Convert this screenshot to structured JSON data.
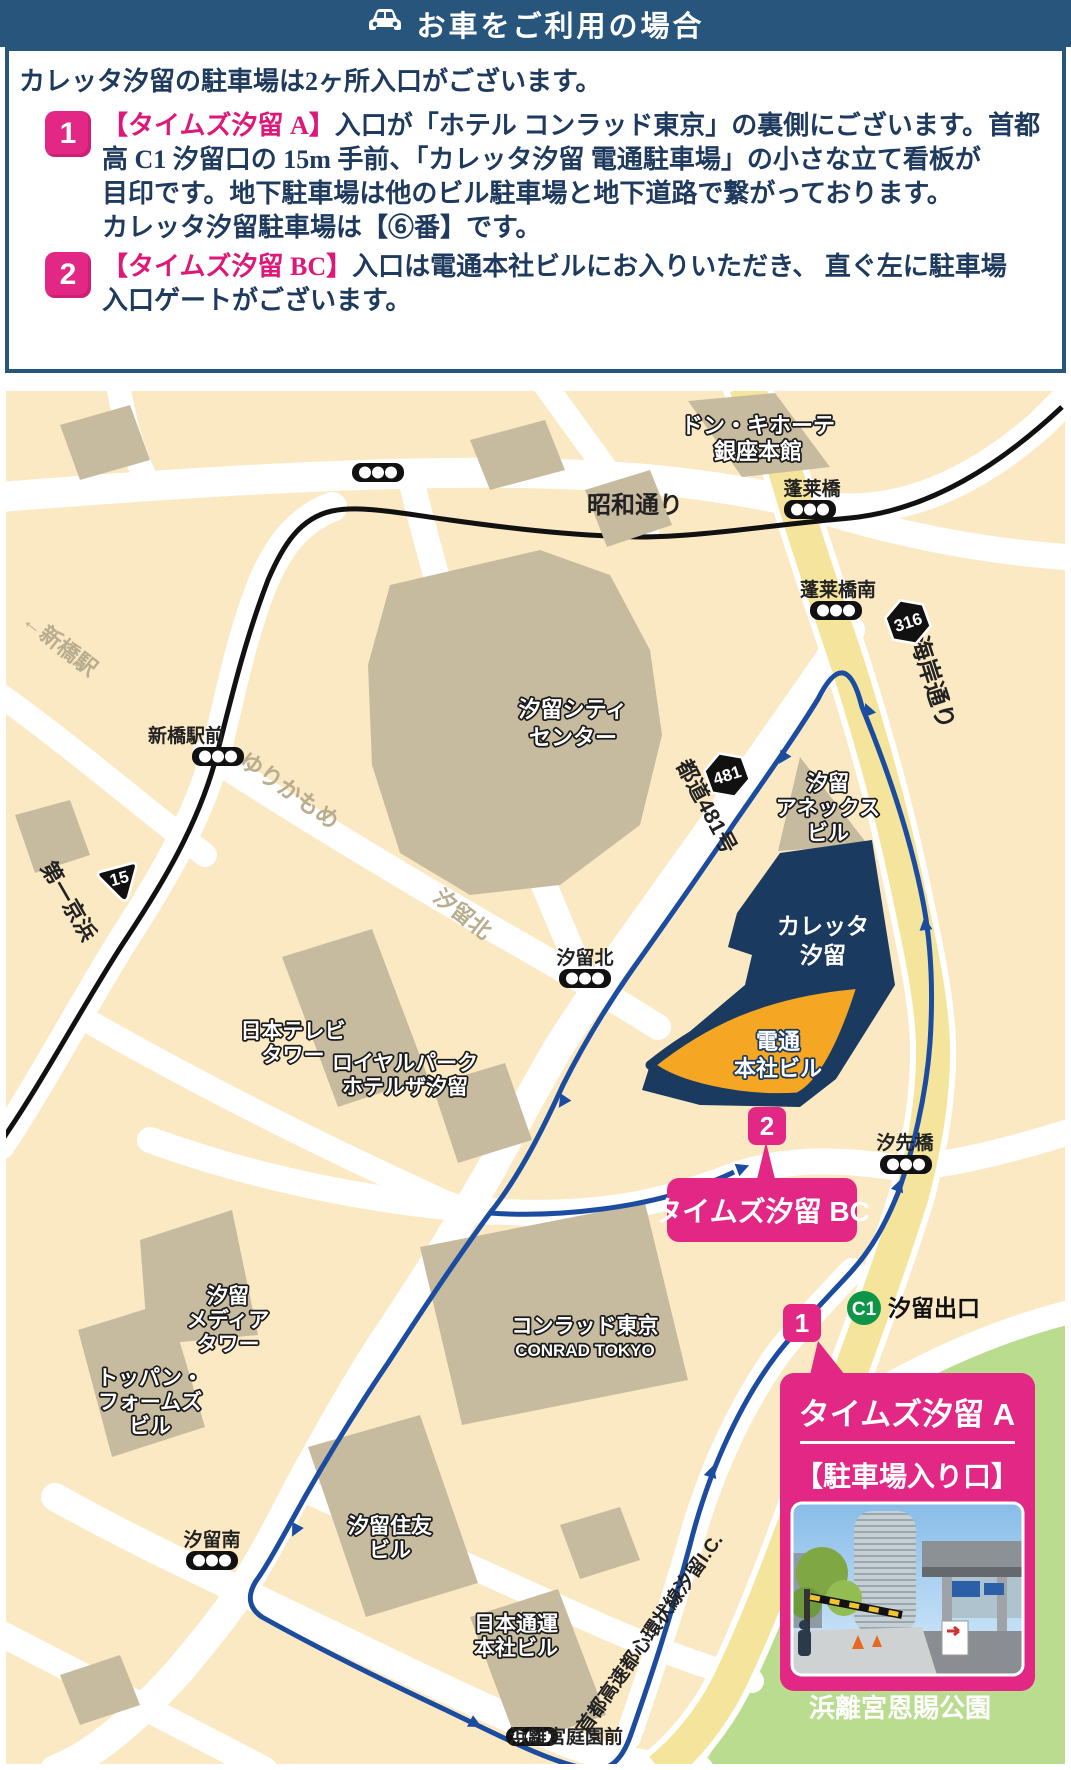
{
  "title_bar": {
    "title": "お車をご利用の場合"
  },
  "intro": "カレッタ汐留の駐車場は2ヶ所入口がございます。",
  "items": [
    {
      "num": "1",
      "head": "【タイムズ汐留 A】",
      "l1": "入口が「ホテル コンラッド東京」の裏側にございます。首都",
      "l2": "高 C1 汐留口の 15m 手前、「カレッタ汐留 電通駐車場」の小さな立て看板が",
      "l3": "目印です。地下駐車場は他のビル駐車場と地下道路で繋がっております。",
      "l4": "カレッタ汐留駐車場は【⑥番】です。"
    },
    {
      "num": "2",
      "head": "【タイムズ汐留 BC】",
      "l1": "入口は電通本社ビルにお入りいただき、 直ぐ左に駐車場",
      "l2": "入口ゲートがございます。"
    }
  ],
  "map": {
    "roads": {
      "showa": "昭和通り",
      "kaigan": "海岸通り",
      "daiichi_keihin": "第一京浜",
      "todo481": "都道481号",
      "yurikamome": "ゆりかもめ",
      "shiodome_kita": "汐留北",
      "shuto": "首都高速都心環状線汐留I.C.",
      "to_shimbashi": "←新橋駅"
    },
    "signals": {
      "horaibashi": "蓬莱橋",
      "horaibashi_minami": "蓬莱橋南",
      "shimbashi_ekimae": "新橋駅前",
      "shiodome_kita": "汐留北",
      "shiosakibashi": "汐先橋",
      "shiodome_minami": "汐留南",
      "hamarikyu_teien_mae": "浜離宮庭園前"
    },
    "badges": {
      "route316": "316",
      "route481": "481",
      "route15": "15",
      "c1": "C1",
      "c1_exit": "汐留出口"
    },
    "buildings": {
      "donki": {
        "l1": "ドン・キホーテ",
        "l2": "銀座本館"
      },
      "city_center": {
        "l1": "汐留シティ",
        "l2": "センター"
      },
      "annex": {
        "l1": "汐留",
        "l2": "アネックス",
        "l3": "ビル"
      },
      "caretta": {
        "l1": "カレッタ",
        "l2": "汐留"
      },
      "dentsu": {
        "l1": "電通",
        "l2": "本社ビル"
      },
      "nittele": {
        "l1": "日本テレビ",
        "l2": "タワー"
      },
      "royalpark": {
        "l1": "ロイヤルパーク",
        "l2": "ホテルザ汐留"
      },
      "media": {
        "l1": "汐留",
        "l2": "メディア",
        "l3": "タワー"
      },
      "toppan": {
        "l1": "トッパン・",
        "l2": "フォームズ",
        "l3": "ビル"
      },
      "conrad": {
        "l1": "コンラッド東京",
        "l2": "CONRAD TOKYO"
      },
      "sumitomo": {
        "l1": "汐留住友",
        "l2": "ビル"
      },
      "nittsu": {
        "l1": "日本通運",
        "l2": "本社ビル"
      }
    },
    "park": "浜離宮恩賜公園",
    "markers": {
      "m1": {
        "num": "1",
        "title": "タイムズ汐留 A",
        "sub": "【駐車場入り口】"
      },
      "m2": {
        "num": "2",
        "label": "タイムズ汐留 BC"
      }
    }
  },
  "colors": {
    "accent_pink": "#E22884",
    "navy": "#27557C",
    "route_blue": "#1C4CA0",
    "map_cream": "#FBE9C4",
    "park_green": "#B9DC8E"
  }
}
